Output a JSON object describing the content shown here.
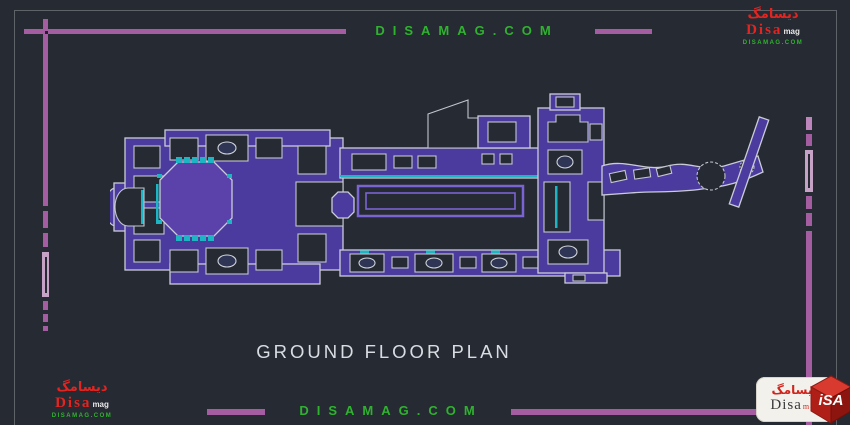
{
  "colors": {
    "background": "#262a32",
    "frame_purple": "#a55da2",
    "frame_light_purple": "#c6a3c6",
    "watermark_green": "#2fb32f",
    "plan_wall_purple": "#4c3b9e",
    "plan_outline_gray": "#c9ccd6",
    "plan_cyan": "#1db4c4",
    "title_text": "#d9dde3",
    "logo_red": "#d92318"
  },
  "watermarks": {
    "top_text": "DISAMAG.COM",
    "bottom_text": "DISAMAG.COM"
  },
  "drawing": {
    "title": "GROUND FLOOR PLAN"
  },
  "logos": {
    "dark": {
      "persian": "دیسامگ",
      "name": "Disa",
      "suffix": "mag",
      "site": "DISAMAG.COM"
    },
    "light": {
      "persian": "دیسامگ",
      "name": "Disa",
      "suffix": "mag",
      "cube_text": "iSA"
    }
  }
}
